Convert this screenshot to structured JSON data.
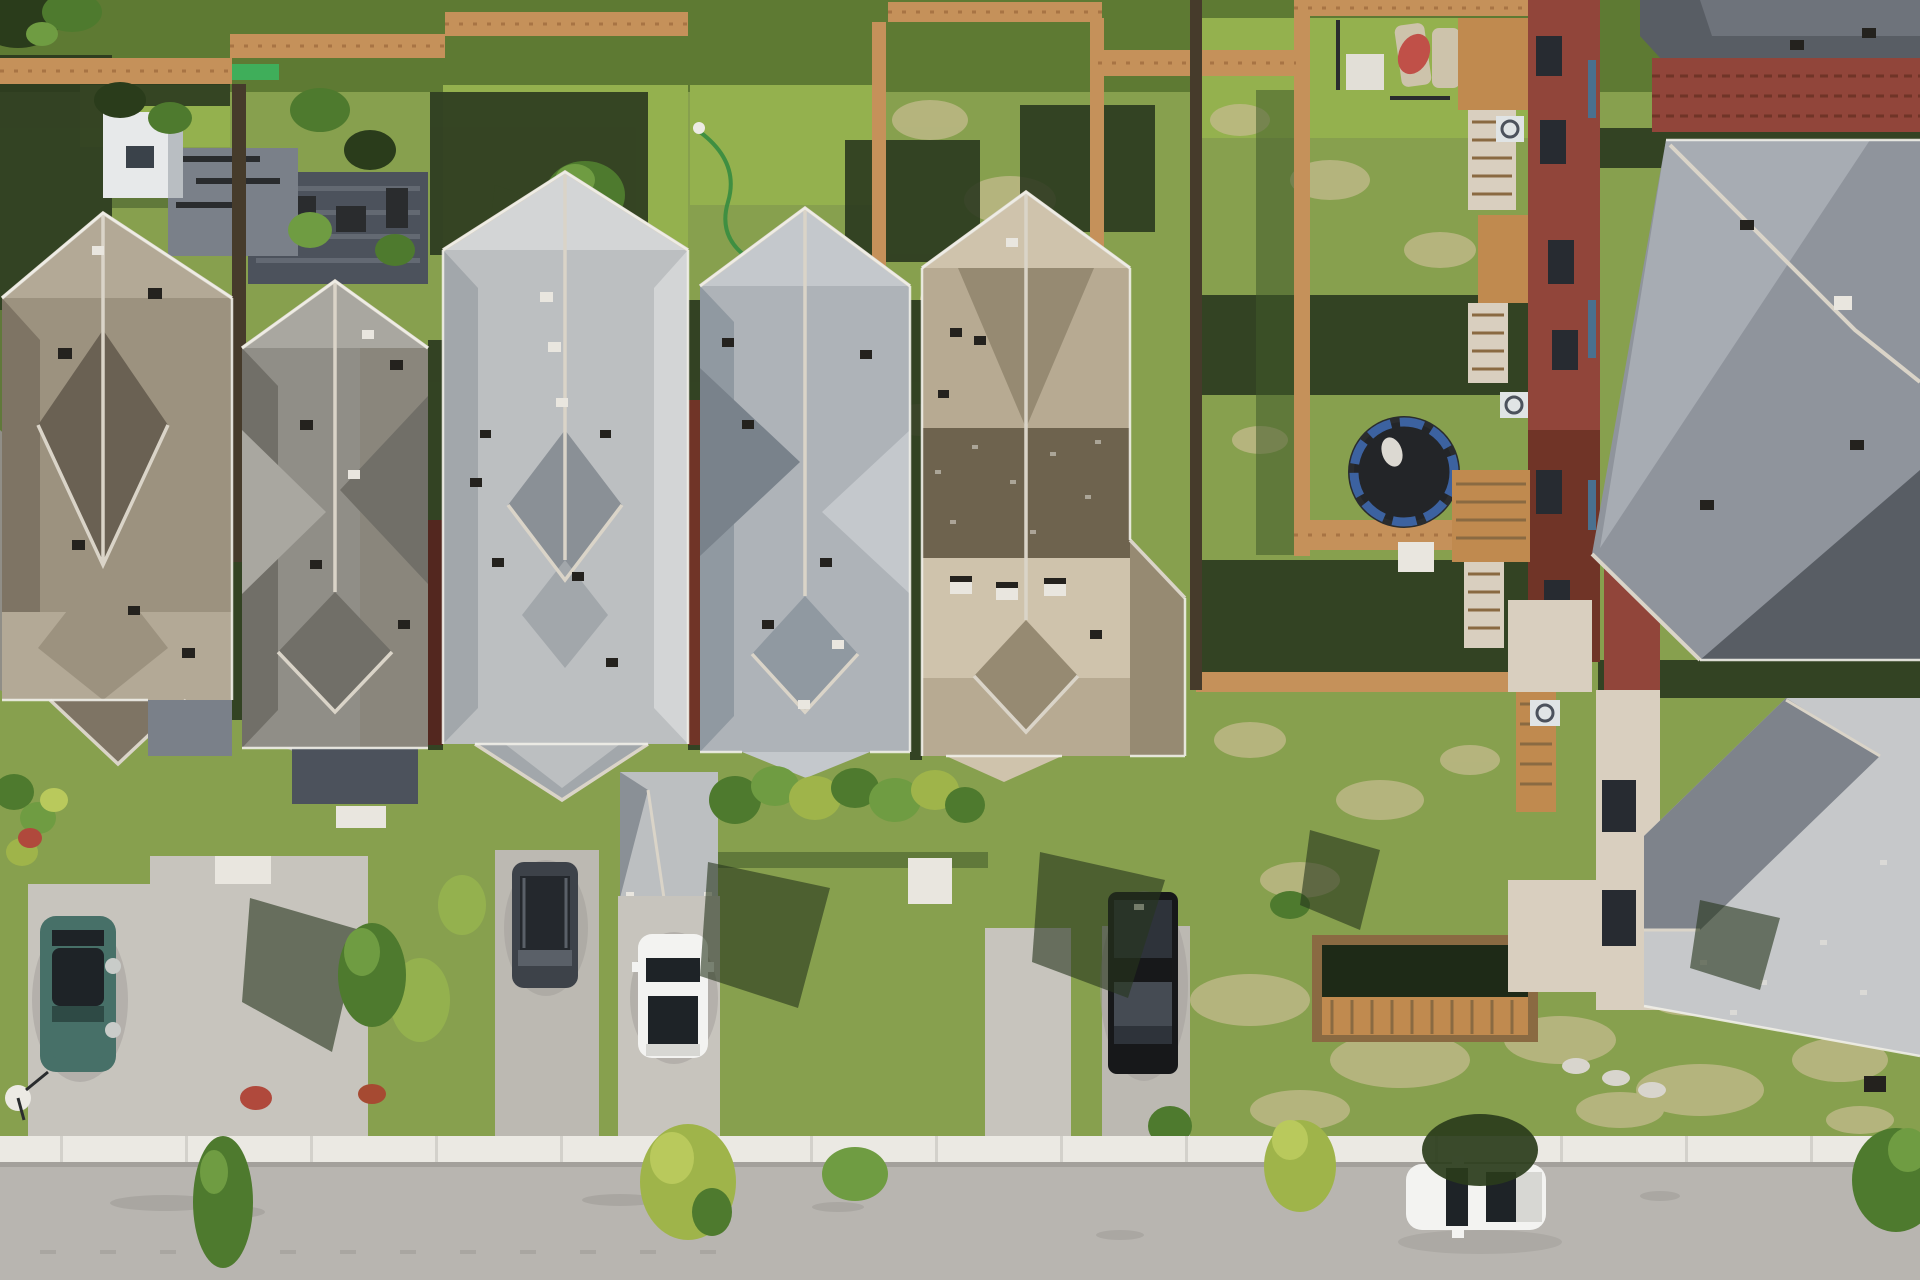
{
  "scene": {
    "description": "Aerial top-down drone photo of a suburban street: five shingled rooftops in a row with backyards above and front driveways below, a row of brick houses with gray roofs on the right, a backyard trampoline, wood privacy fences, five vehicles, a white sidewalk and an asphalt street across the bottom.",
    "view": "top-down aerial",
    "lighting": "bright midday sun, shadows cast toward upper left"
  },
  "palette": {
    "grass_base": "#87A04E",
    "grass_other": "#5E7A33",
    "grass_bright": "#94B14E",
    "grass_patch": "#A8A96A",
    "grass_dry": "#C4BB8D",
    "shadow_dark": "#27351D",
    "shadow_soft": "#3F5A29",
    "patio_stone": "#7A8089",
    "patio_dark": "#4C525C",
    "garden_green": "#3FAE5A",
    "shed_white": "#E7E9EA",
    "shed_gray": "#B9BEC2",
    "shed_panel": "#3A424A",
    "hose_green": "#3F8F41",
    "lamp_white": "#EDEBE5",
    "fence_orange": "#C5915A",
    "fence_plank": "#A87444",
    "fence_dark": "#463B2B",
    "tramp_mat": "#232528",
    "tramp_rim": "#3C62A0",
    "towel_white": "#DCD9D2",
    "table_white": "#E2DFD7",
    "lounger_beige": "#CDC3AB",
    "umbrella_red": "#C05048",
    "frame_dark": "#2A2C2E",
    "brick": "#91453A",
    "brick_dark": "#703427",
    "brick_deep": "#53271F",
    "window_dark": "#272B31",
    "window_blue": "#49708F",
    "wood_deck": "#C08A4F",
    "wood_light": "#D9CFBF",
    "wood_dark": "#8A6A42",
    "deck_shadow": "#1E2A17",
    "ac_white": "#E0E4E5",
    "stone_path": "#D8D5CD",
    "roofR_deep": "#585D64",
    "roofR_dark": "#6E737B",
    "roofR_mid": "#8F949C",
    "roofR_light": "#A7ACB3",
    "roofR2_light": "#C6C8CA",
    "roofR2_dark": "#7E838B",
    "roof1_light": "#B3A996",
    "roof1_mid": "#9C927F",
    "roof1_dark": "#7E7464",
    "roof1_deep": "#6A6153",
    "roof2_light": "#A9A7A0",
    "roof2_mid": "#908E87",
    "roof2_dark": "#716F68",
    "roof2_brown": "#857F72",
    "roof3_light": "#D3D5D6",
    "roof3_mid": "#BCBFC1",
    "roof3_dark": "#A2A7AB",
    "roof3_deep": "#8A9096",
    "roof4_light": "#C4C8CC",
    "roof4_mid": "#AEB3B8",
    "roof4_dark": "#9099A1",
    "roof4_deep": "#79828B",
    "roof5_light": "#CFC3AC",
    "roof5_mid": "#B7AA92",
    "roof5_dark": "#968A72",
    "roof5_deep": "#6E634E",
    "ridge_light": "#DAD4C8",
    "gutter": "#F0EEE8",
    "vent_dark": "#24221E",
    "vent_light": "#E9E6DF",
    "driveway": "#C7C4BD",
    "driveway_dark": "#BCB9B2",
    "sidewalk": "#EBE9E3",
    "sidewalk_seam": "#D3D1CB",
    "curb_shadow": "#A3A09B",
    "street": "#B8B5B0",
    "street_dark": "#A4A19C",
    "car_teal": "#477068",
    "car_teal_dark": "#2E4A45",
    "glass_dark": "#1E2327",
    "wheel_light": "#C9CCC9",
    "van_body": "#3D4249",
    "van_glass": "#24282D",
    "van_light": "#5A6068",
    "car_white": "#F3F3F1",
    "car_white_shade": "#D7D7D3",
    "truck_black": "#17181A",
    "truck_glass": "#2E333A",
    "truck_glint": "#454B53",
    "flower_red": "#B0493C",
    "flower_rust": "#A64A32",
    "tree_green": "#4E7A2E",
    "tree_light": "#6F9C42",
    "tree_yellow": "#9FB44A",
    "tree_bright": "#B9C95C",
    "tree_dark": "#2A3C1B",
    "dish_white": "#ECEAE4"
  },
  "inventory": {
    "houses_left_row": 5,
    "houses_right_column": 3,
    "roofs_left_row": [
      "warm gray-tan hip roof",
      "medium gray hip roof",
      "pale silver hip roof",
      "pale blue-gray hip roof",
      "tan hip roof with dark band and ridge vents"
    ],
    "roofs_right": [
      "dark gray roof",
      "large blue-gray hip roof",
      "light speckled gray roof"
    ],
    "vehicles": [
      {
        "vehicle": "suv",
        "color": "teal green",
        "location": "far left driveway"
      },
      {
        "vehicle": "minivan",
        "color": "dark gray",
        "location": "center-left driveway"
      },
      {
        "vehicle": "sedan",
        "color": "white",
        "location": "center driveway"
      },
      {
        "vehicle": "pickup truck",
        "color": "black",
        "location": "center-right driveway"
      },
      {
        "vehicle": "suv",
        "color": "white",
        "location": "parked on street, lower right"
      }
    ],
    "backyard_items": [
      "trampoline with blue rim",
      "lounge chairs",
      "red patio umbrella",
      "white patio table",
      "white garden shed",
      "storage structure",
      "wood privacy fences",
      "rear decks with stairs",
      "air conditioner units",
      "garden hose",
      "shadowed paver patio",
      "fenced rear deck enclosure"
    ],
    "front_items": [
      "concrete driveways",
      "hedge row",
      "street trees",
      "tree shadows",
      "red flower patches",
      "satellite dish",
      "white porch steps",
      "sidewalk",
      "asphalt street with tire marks"
    ]
  }
}
